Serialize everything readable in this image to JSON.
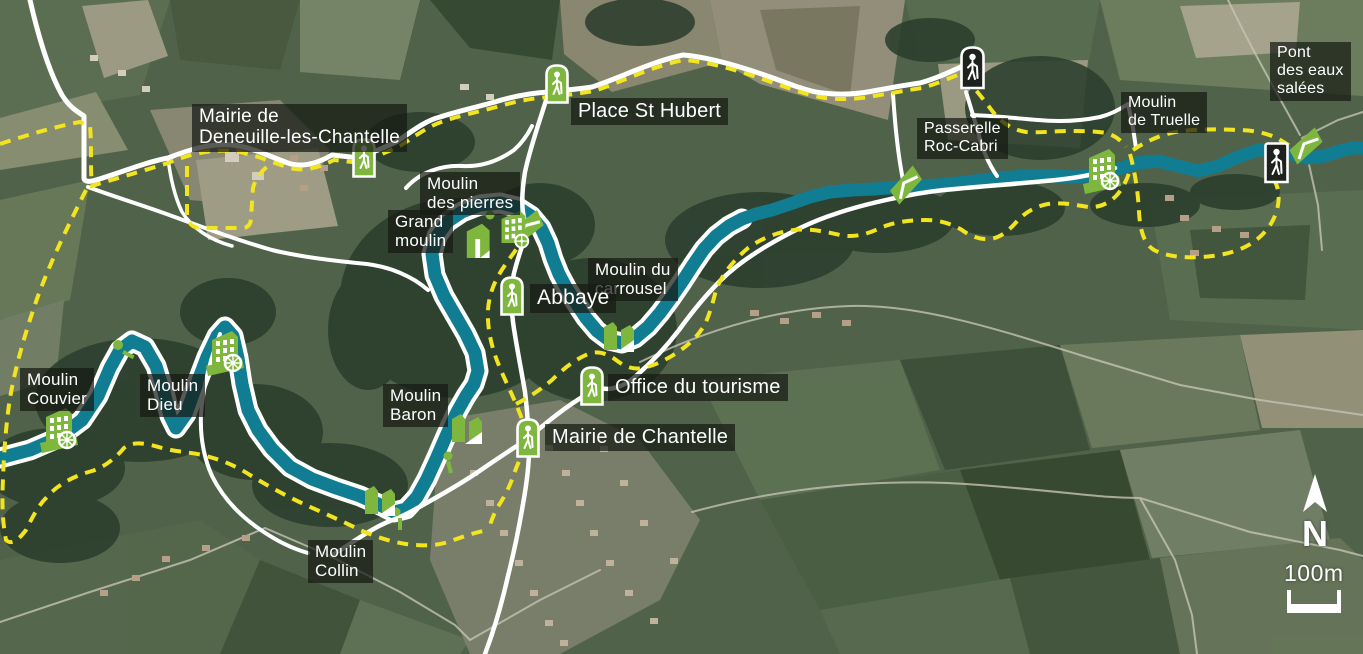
{
  "labels": {
    "mairie_deneuille": {
      "line1": "Mairie de",
      "line2": "Deneuille-les-Chantelle"
    },
    "place_st_hubert": {
      "text": "Place St Hubert"
    },
    "moulin_des_pierres": {
      "line1": "Moulin",
      "line2": "des pierres"
    },
    "grand_moulin": {
      "line1": "Grand",
      "line2": "moulin"
    },
    "moulin_du_carrousel": {
      "line1": "Moulin du",
      "line2": "carrousel"
    },
    "abbaye": {
      "text": "Abbaye"
    },
    "office_du_tourisme": {
      "text": "Office du tourisme"
    },
    "mairie_de_chantelle": {
      "text": "Mairie de Chantelle"
    },
    "moulin_baron": {
      "line1": "Moulin",
      "line2": "Baron"
    },
    "moulin_collin": {
      "line1": "Moulin",
      "line2": "Collin"
    },
    "moulin_couvier": {
      "line1": "Moulin",
      "line2": "Couvier"
    },
    "moulin_dieu": {
      "line1": "Moulin",
      "line2": "Dieu"
    },
    "passerelle_roc_cabri": {
      "line1": "Passerelle",
      "line2": "Roc-Cabri"
    },
    "moulin_de_truelle": {
      "line1": "Moulin",
      "line2": "de Truelle"
    },
    "pont_des_eaux_salees": {
      "line1": "Pont",
      "line2": "des eaux",
      "line3": "salées"
    }
  },
  "compass": {
    "label": "N"
  },
  "scale_bar": {
    "label": "100m"
  },
  "legend_colors": {
    "river": "#117d92",
    "walking_path": "#ffffff",
    "trail_dashed": "#f2e41f",
    "poi_green": "#7fb73e",
    "label_background": "rgba(22,26,20,0.72)"
  },
  "icons": {
    "hiker_green": "walking-person-green-marker",
    "hiker_dark": "walking-person-dark-marker",
    "mill_wheel": "watermill-building-with-wheel",
    "mill_simple": "mill-building",
    "mill_weir": "mill-with-weir",
    "bridge": "footbridge-marker",
    "north_arrow": "north-arrow"
  }
}
